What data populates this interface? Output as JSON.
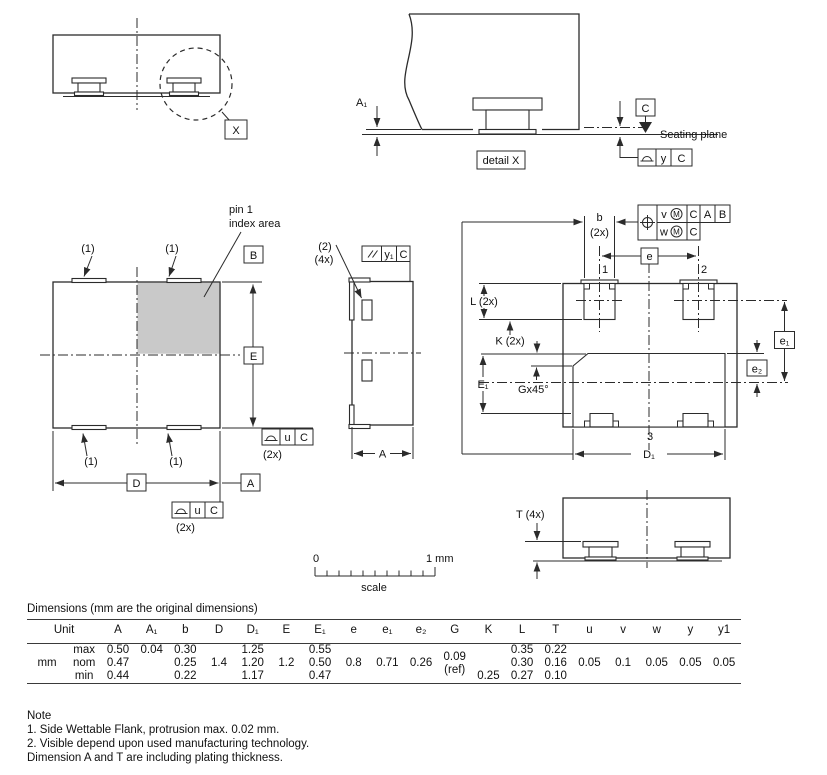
{
  "colors": {
    "line": "#2b2b2b",
    "pin1_area": "#c9c9c9",
    "text": "#111111"
  },
  "views": {
    "package_side": {
      "detail_ref": "X"
    },
    "detail_x": {
      "dim_a1": "A₁",
      "datum": "C",
      "seating_plane": "Seating plane",
      "caption": "detail X",
      "tolerance": "y",
      "tolerance_datum": "C"
    },
    "top": {
      "pin1_line1": "pin 1",
      "pin1_line2": "index area",
      "qty": [
        "(1)",
        "(1)",
        "(1)",
        "(1)"
      ],
      "datum_b": "B",
      "datum_a": "A",
      "dim_e": "E",
      "dim_d": "D",
      "tol1": "u",
      "tol1_datum": "C",
      "tol1_qty": "(2x)",
      "tol2": "u",
      "tol2_datum": "C",
      "tol2_qty": "(2x)"
    },
    "front": {
      "note": "(2)",
      "qty": "(4x)",
      "par_tol": "y₁",
      "par_datum": "C",
      "dim_a": "A"
    },
    "bottom": {
      "dim_b": "b",
      "dim_b_qty": "(2x)",
      "pos_v": "v",
      "pos_m1": "M",
      "pos_c1": "C",
      "pos_a": "A",
      "pos_b": "B",
      "pos_w": "w",
      "pos_m2": "M",
      "pos_c2": "C",
      "dim_e": "e",
      "pin1": "1",
      "pin2": "2",
      "pin3": "3",
      "dim_l": "L (2x)",
      "dim_k": "K (2x)",
      "dim_e1_body": "E₁",
      "chamfer": "Gx45°",
      "dim_e1": "e₁",
      "dim_e2": "e₂",
      "dim_d1": "D₁"
    },
    "t_side": {
      "dim_t": "T (4x)"
    }
  },
  "scale_bar": {
    "start": "0",
    "end": "1 mm",
    "caption": "scale"
  },
  "table": {
    "title": "Dimensions (mm are the original dimensions)",
    "headers": [
      "Unit",
      "A",
      "A₁",
      "b",
      "D",
      "D₁",
      "E",
      "E₁",
      "e",
      "e₁",
      "e₂",
      "G",
      "K",
      "L",
      "T",
      "u",
      "v",
      "w",
      "y",
      "y1"
    ],
    "unit": "mm",
    "row_labels": [
      "max",
      "nom",
      "min"
    ],
    "max": {
      "A": "0.50",
      "A1": "0.04",
      "b": "0.30",
      "D1": "1.25",
      "E1": "0.55",
      "K": "",
      "L": "0.35",
      "T": "0.22"
    },
    "nom": {
      "A": "0.47",
      "A1": "",
      "b": "0.25",
      "D": "1.4",
      "D1": "1.20",
      "E": "1.2",
      "E1": "0.50",
      "e": "0.8",
      "e1": "0.71",
      "e2": "0.26",
      "G1": "0.09",
      "G2": "(ref)",
      "K": "",
      "L": "0.30",
      "T": "0.16",
      "u": "0.05",
      "v": "0.1",
      "w": "0.05",
      "y": "0.05",
      "y1": "0.05"
    },
    "min": {
      "A": "0.44",
      "A1": "",
      "b": "0.22",
      "D1": "1.17",
      "E1": "0.47",
      "K": "0.25",
      "L": "0.27",
      "T": "0.10"
    }
  },
  "notes": {
    "heading": "Note",
    "items": [
      "1. Side Wettable Flank, protrusion max. 0.02 mm.",
      "2. Visible depend upon used manufacturing technology.",
      "Dimension A and T are including plating thickness."
    ]
  }
}
